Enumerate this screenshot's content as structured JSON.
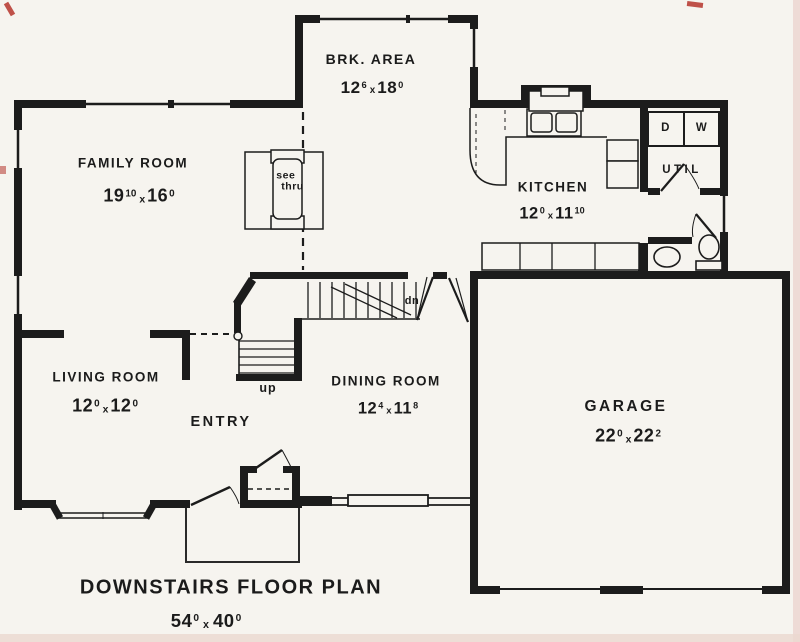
{
  "title": {
    "text": "DOWNSTAIRS FLOOR PLAN",
    "dim": {
      "w": "54",
      "wsup": "0",
      "x": "x",
      "h": "40",
      "hsup": "0"
    }
  },
  "rooms": {
    "brk_area": {
      "name": "BRK. AREA",
      "dim": {
        "w": "12",
        "wsup": "6",
        "x": "x",
        "h": "18",
        "hsup": "0"
      }
    },
    "family_room": {
      "name": "FAMILY ROOM",
      "dim": {
        "w": "19",
        "wsup": "10",
        "x": "x",
        "h": "16",
        "hsup": "0"
      }
    },
    "kitchen": {
      "name": "KITCHEN",
      "dim": {
        "w": "12",
        "wsup": "0",
        "x": "x",
        "h": "11",
        "hsup": "10"
      }
    },
    "living_room": {
      "name": "LIVING ROOM",
      "dim": {
        "w": "12",
        "wsup": "0",
        "x": "x",
        "h": "12",
        "hsup": "0"
      }
    },
    "dining_room": {
      "name": "DINING ROOM",
      "dim": {
        "w": "12",
        "wsup": "4",
        "x": "x",
        "h": "11",
        "hsup": "8"
      }
    },
    "garage": {
      "name": "GARAGE",
      "dim": {
        "w": "22",
        "wsup": "0",
        "x": "x",
        "h": "22",
        "hsup": "2"
      }
    },
    "entry": {
      "name": "ENTRY"
    },
    "util": {
      "name": "UTIL"
    }
  },
  "appliances": {
    "dryer": "D",
    "washer": "W"
  },
  "fireplace": {
    "line1": "see",
    "line2": "thru"
  },
  "stairs": {
    "down": "dn",
    "up": "up"
  },
  "colors": {
    "ink": "#1c1c1c",
    "paper": "#f6f4ef",
    "scan_edge": "#ecd4cf"
  }
}
